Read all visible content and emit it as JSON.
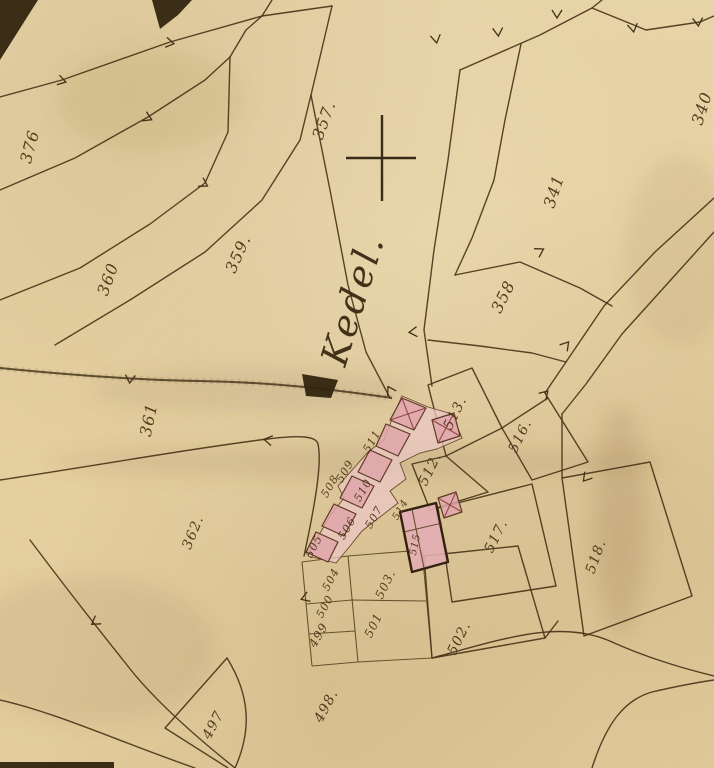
{
  "map": {
    "place_name_label": {
      "text": "Kedel.",
      "x": 365,
      "y": 303,
      "rot": -73,
      "size": 37
    },
    "survey_cross": {
      "symbol": "+",
      "x": 382,
      "y": 158
    },
    "colors": {
      "paper": "#e8d3a4",
      "ink": "#4b3419",
      "building_fill": "#dfa6ab",
      "building_band": "#ecc8c6",
      "dark_accent": "#32250f"
    },
    "parcel_labels": [
      {
        "text": "376",
        "x": 35,
        "y": 148,
        "rot": -75,
        "size": 16
      },
      {
        "text": "360",
        "x": 113,
        "y": 281,
        "rot": -70,
        "size": 16
      },
      {
        "text": "359.",
        "x": 243,
        "y": 256,
        "rot": -66,
        "size": 16
      },
      {
        "text": "357.",
        "x": 329,
        "y": 122,
        "rot": -70,
        "size": 16
      },
      {
        "text": "341",
        "x": 559,
        "y": 193,
        "rot": -72,
        "size": 16
      },
      {
        "text": "340",
        "x": 707,
        "y": 110,
        "rot": -72,
        "size": 16
      },
      {
        "text": "358",
        "x": 508,
        "y": 299,
        "rot": -64,
        "size": 16
      },
      {
        "text": "361",
        "x": 154,
        "y": 421,
        "rot": -78,
        "size": 16
      },
      {
        "text": "362.",
        "x": 197,
        "y": 534,
        "rot": -68,
        "size": 14
      },
      {
        "text": "513.",
        "x": 459,
        "y": 415,
        "rot": -64,
        "size": 14
      },
      {
        "text": "516.",
        "x": 524,
        "y": 438,
        "rot": -64,
        "size": 14
      },
      {
        "text": "512.",
        "x": 434,
        "y": 471,
        "rot": -64,
        "size": 14
      },
      {
        "text": "517.",
        "x": 500,
        "y": 538,
        "rot": -64,
        "size": 14
      },
      {
        "text": "518.",
        "x": 600,
        "y": 558,
        "rot": -70,
        "size": 14
      },
      {
        "text": "502.",
        "x": 463,
        "y": 640,
        "rot": -64,
        "size": 14
      },
      {
        "text": "503.",
        "x": 389,
        "y": 586,
        "rot": -64,
        "size": 12
      },
      {
        "text": "501",
        "x": 377,
        "y": 627,
        "rot": -64,
        "size": 12
      },
      {
        "text": "500",
        "x": 328,
        "y": 608,
        "rot": -62,
        "size": 11
      },
      {
        "text": "504",
        "x": 334,
        "y": 581,
        "rot": -62,
        "size": 11
      },
      {
        "text": "505",
        "x": 317,
        "y": 548,
        "rot": -62,
        "size": 11
      },
      {
        "text": "499",
        "x": 322,
        "y": 637,
        "rot": -60,
        "size": 12
      },
      {
        "text": "498.",
        "x": 330,
        "y": 708,
        "rot": -62,
        "size": 14
      },
      {
        "text": "497",
        "x": 217,
        "y": 727,
        "rot": -62,
        "size": 14
      },
      {
        "text": "506",
        "x": 350,
        "y": 530,
        "rot": -60,
        "size": 11
      },
      {
        "text": "507",
        "x": 377,
        "y": 519,
        "rot": -60,
        "size": 11
      },
      {
        "text": "508",
        "x": 333,
        "y": 488,
        "rot": -60,
        "size": 11
      },
      {
        "text": "509",
        "x": 348,
        "y": 473,
        "rot": -60,
        "size": 11
      },
      {
        "text": "510",
        "x": 366,
        "y": 492,
        "rot": -60,
        "size": 11
      },
      {
        "text": "511",
        "x": 375,
        "y": 443,
        "rot": -60,
        "size": 11
      },
      {
        "text": "514",
        "x": 403,
        "y": 511,
        "rot": -60,
        "size": 10
      },
      {
        "text": "515",
        "x": 418,
        "y": 545,
        "rot": -78,
        "size": 10
      }
    ]
  }
}
